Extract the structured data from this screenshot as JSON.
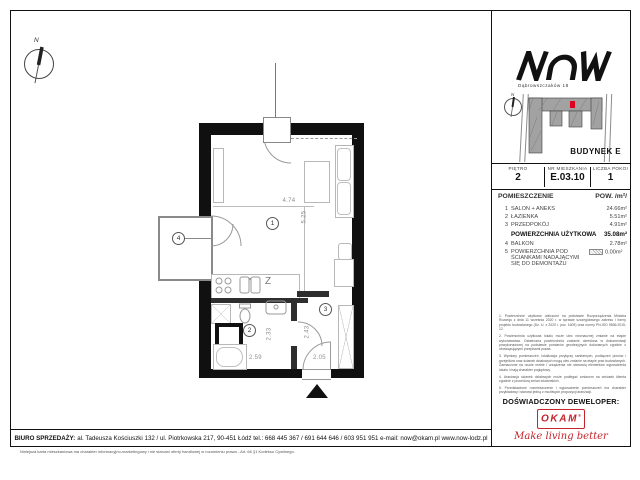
{
  "brand": {
    "logo_text": "NOW",
    "logo_subtitle": "Dąbrowszczaków 18"
  },
  "site_map": {
    "building_label": "BUDYNEK E",
    "north_letter": "N",
    "marker_color": "#e00020"
  },
  "unit_info": {
    "floor_label": "PIĘTRO",
    "floor_value": "2",
    "apartment_label": "NR MIESZKANIA",
    "apartment_value": "E.03.10",
    "rooms_label": "LICZBA POKOI",
    "rooms_value": "1"
  },
  "room_schedule": {
    "header_name": "POMIESZCZENIE",
    "header_area": "POW. /m²/",
    "rows": [
      {
        "no": "1",
        "name": "SALON + ANEKS",
        "area": "24.66m²"
      },
      {
        "no": "2",
        "name": "ŁAZIENKA",
        "area": "5.51m²"
      },
      {
        "no": "3",
        "name": "PRZEDPOKÓJ",
        "area": "4.91m²"
      }
    ],
    "total_label": "POWIERZCHNIA UŻYTKOWA",
    "total_area": "35.08m²",
    "extra_rows": [
      {
        "no": "4",
        "name": "BALKON",
        "area": "2.78m²"
      },
      {
        "no": "5",
        "name": "POWIERZCHNIA POD ŚCIANKAMI NADAJĄCYMI SIĘ DO DEMONTAŻU",
        "area": "0.00m²"
      }
    ]
  },
  "fine_print": {
    "p1": "1. Powierzchnie użytkowe obliczone na podstawie Rozporządzenia Ministra Rozwoju z dnia 11 września 2020 r. w sprawie szczegółowego zakresu i formy projektu budowlanego (Dz. U. z 2020 r. poz. 1609) oraz normy PN-ISO 9836:2015-12.",
    "p2": "2. Powierzchnia użytkowa lokalu może ulec nieznacznej zmianie na etapie wykonawstwa. Ostateczna powierzchnia zostanie określona w dokumentacji powykonawczej na podstawie pomiarów geodezyjnych dokonanych zgodnie z obowiązującymi przepisami prawa.",
    "p3": "3. Wymiary pomieszczeń, lokalizacja przyłączy sanitarnych, podłączeń pionów i grzejników oraz ścianek działowych mogą ulec zmianie na etapie prac budowlanych. Zaznaczone na rzucie meble i urządzenia nie stanowią elementów wyposażenia lokalu i mają charakter poglądowy.",
    "p4": "4. Aranżacja ścianek działowych może podlegać zmianom na wniosek klienta zgodnie z procedurą zmian lokatorskich.",
    "p5": "5. Przedstawione rozmieszczenie i wyposażenie pomieszczeń ma charakter przykładowy i stanowi jedną z możliwych propozycji aranżacji."
  },
  "developer": {
    "heading": "DOŚWIADCZONY DEWELOPER:",
    "logo_text": "OKAM",
    "logo_mark": "®",
    "tagline": "Make living better",
    "accent_color": "#c6242b"
  },
  "sales_office": {
    "label": "BIURO SPRZEDAŻY:",
    "text": "al. Tadeusza Kościuszki 132 / ul. Piotrkowska 217, 90-451 Łódź tel.: 668 445 367 / 691 644 646 / 603 951 951 e-mail: now@okam.pl www.now-lodz.pl"
  },
  "page": {
    "footer_disclaimer": "Niniejsza karta mieszkaniowa ma charakter informacyjno-marketingowy i nie stanowi oferty handlowej w rozumieniu prawa - Art. 66 §1 Kodeksu Cywilnego.",
    "north_letter": "N"
  },
  "plan": {
    "labels": {
      "room1": "1",
      "room2": "2",
      "room3": "3",
      "room4": "4",
      "kitchen_z": "Z"
    },
    "dimensions": {
      "salon_width": "4.74",
      "salon_height": "5.25",
      "bathroom_width": "2.59",
      "bathroom_height": "2.33",
      "hall_height": "2.43",
      "hall_width": "2.05"
    }
  }
}
